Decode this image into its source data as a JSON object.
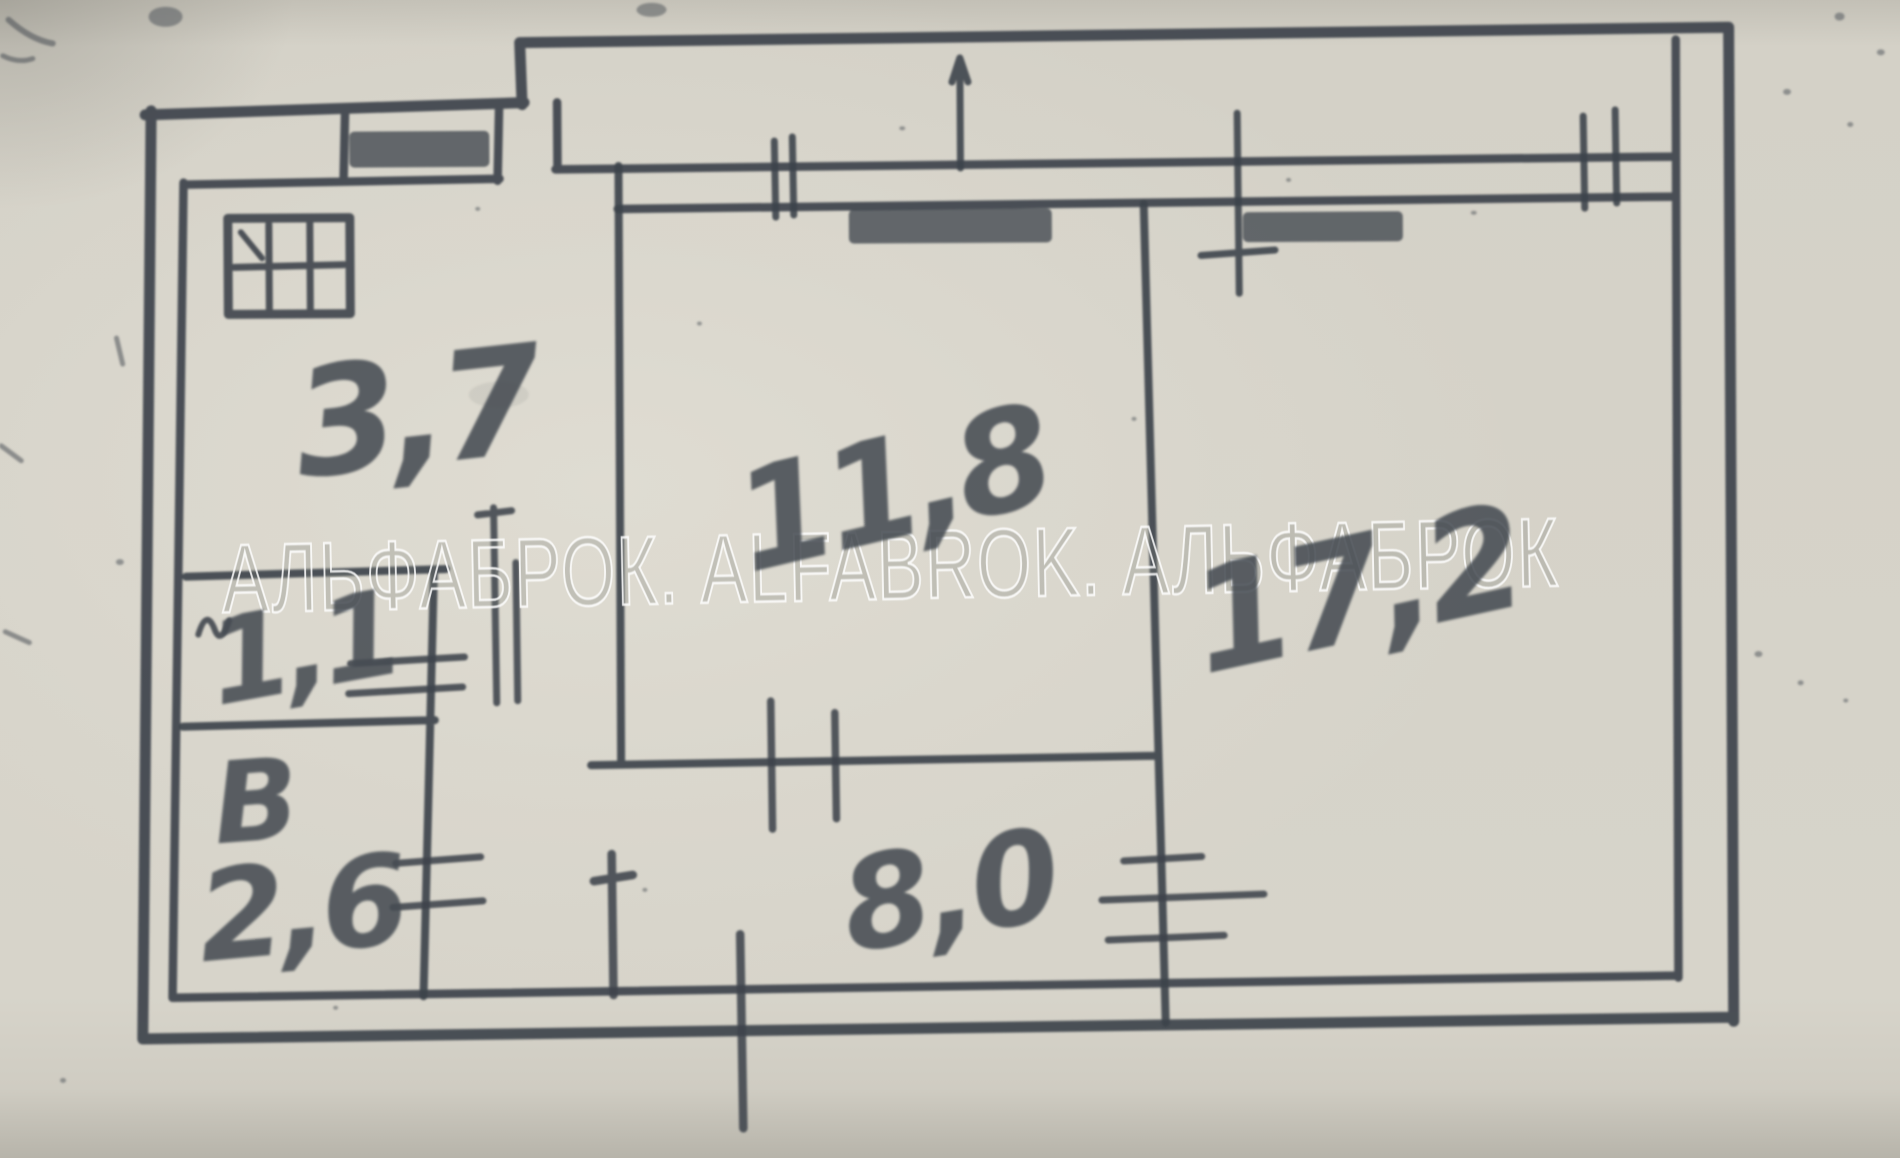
{
  "watermark": {
    "text": "АЛЬФАБРОК. ALFABROK. АЛЬФАБРОК"
  },
  "rooms": {
    "kitchen": {
      "area": "3,7"
    },
    "toilet": {
      "area": "1,1"
    },
    "bathroom": {
      "letter": "В",
      "area": "2,6"
    },
    "living": {
      "area": "11,8"
    },
    "hallway": {
      "area": "8,0"
    },
    "bedroom": {
      "area": "17,2"
    }
  },
  "colors": {
    "paper": "#d5d2c8",
    "ink": "#3d434b",
    "watermark_stroke": "#ffffff"
  }
}
